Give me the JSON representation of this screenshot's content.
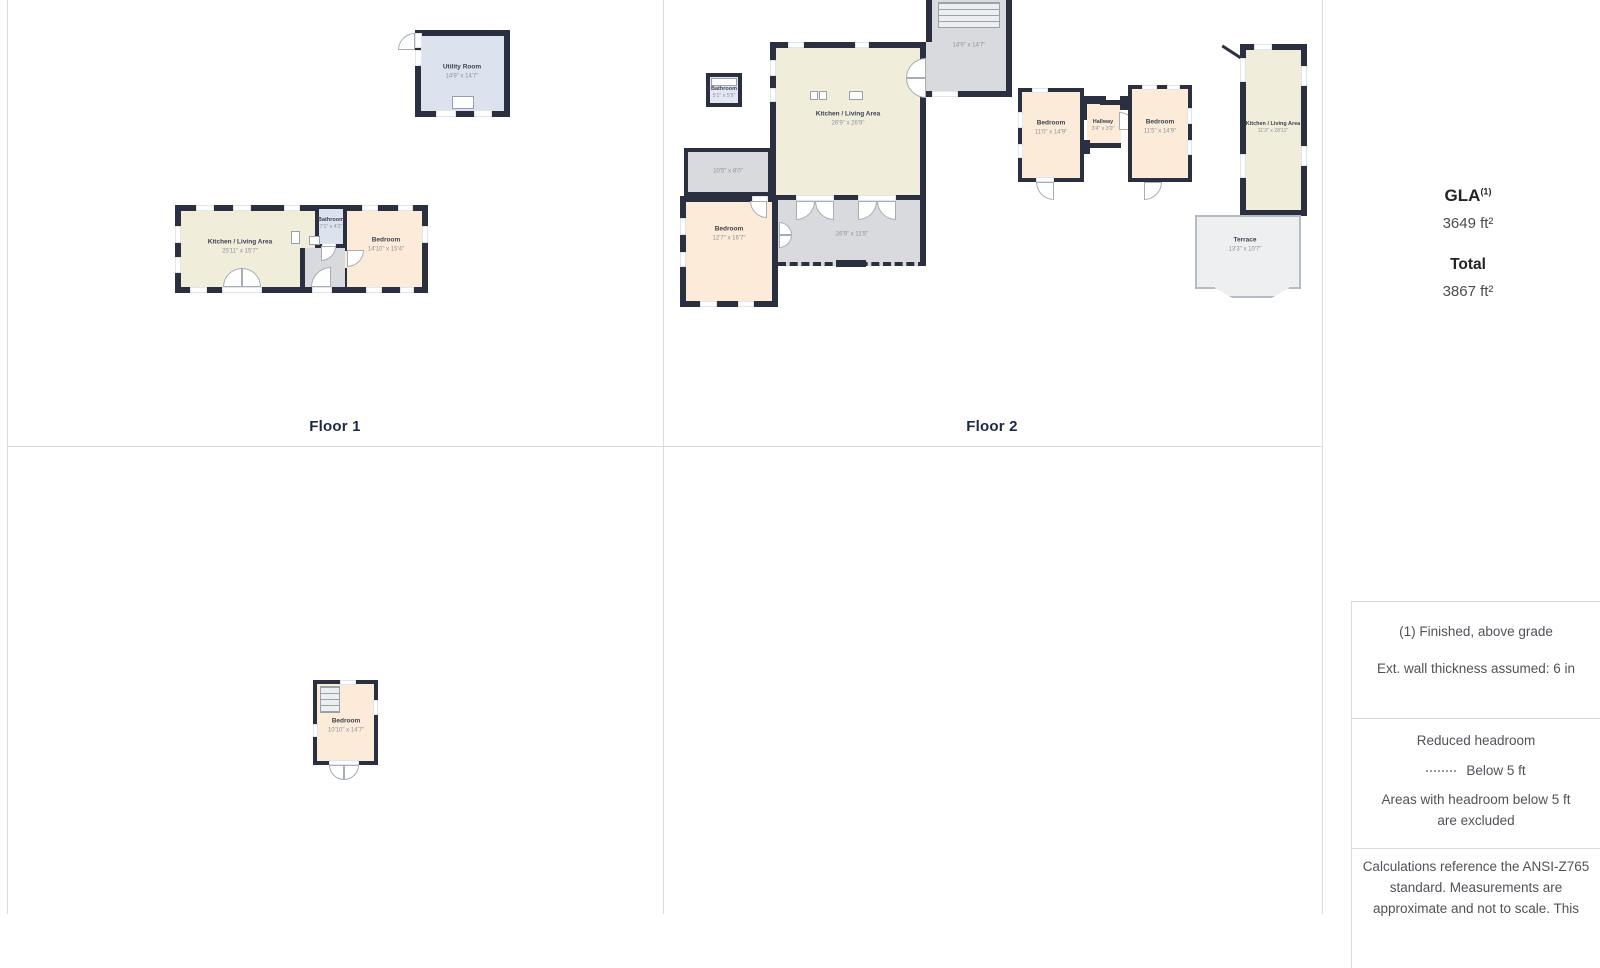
{
  "palette": {
    "wall": "#2a3040",
    "living_fill": "#f0eddb",
    "bedroom_fill": "#fcebd9",
    "wet_fill": "#dce3ef",
    "gray_fill": "#d8dadd",
    "terrace_fill": "#edeff1",
    "grid_line": "#d9dce1"
  },
  "floors": {
    "floor1": {
      "label": "Floor 1"
    },
    "floor2": {
      "label": "Floor 2"
    }
  },
  "rooms": {
    "f1_utility": {
      "name": "Utility Room",
      "dims": "14'9\" x 14'7\""
    },
    "f1_kitchen": {
      "name": "Kitchen / Living Area",
      "dims": "25'11\" x 15'7\""
    },
    "f1_bath": {
      "name": "Bathroom",
      "dims": "7'1\" x 4'2\""
    },
    "f1_bedroom": {
      "name": "Bedroom",
      "dims": "14'10\" x 15'4\""
    },
    "f2_bath": {
      "name": "Bathroom",
      "dims": "5'1\" x 5'5\""
    },
    "f2_kitchen": {
      "name": "Kitchen / Living Area",
      "dims": "26'9\" x 26'9\""
    },
    "f2_stairs": {
      "dims": "14'9\" x 14'7\""
    },
    "f2_grayroom": {
      "dims": "10'5\" x 8'0\""
    },
    "f2_bedroom_left": {
      "name": "Bedroom",
      "dims": "12'7\" x 16'7\""
    },
    "f2_deck": {
      "dims": "26'9\" x 11'5\""
    },
    "f2_bedroom_a": {
      "name": "Bedroom",
      "dims": "11'0\" x 14'9\""
    },
    "f2_hallway": {
      "name": "Hallway",
      "dims": "3'4\" x 3'0\""
    },
    "f2_bedroom_b": {
      "name": "Bedroom",
      "dims": "11'5\" x 14'9\""
    },
    "f2_kitchen2": {
      "name": "Kitchen / Living Area",
      "dims": "11'3\" x 28'11\""
    },
    "f2_terrace": {
      "name": "Terrace",
      "dims": "13'3\" x 10'7\""
    },
    "f3_bedroom": {
      "name": "Bedroom",
      "dims": "10'10\" x 14'7\""
    }
  },
  "sidebar": {
    "gla_label": "GLA",
    "gla_sup": "(1)",
    "gla_value": "3649 ft²",
    "total_label": "Total",
    "total_value": "3867 ft²",
    "note_finished": "(1) Finished, above grade",
    "note_wall": "Ext. wall thickness assumed: 6 in",
    "headroom_title": "Reduced headroom",
    "headroom_below": "Below 5 ft",
    "headroom_note": "Areas with headroom below 5 ft are excluded",
    "calc_note": "Calculations reference the ANSI-Z765 standard. Measurements are approximate and not to scale. This"
  }
}
